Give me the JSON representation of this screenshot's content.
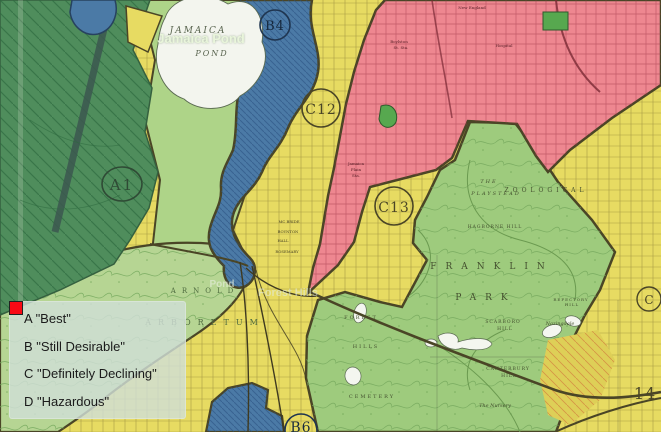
{
  "legend": {
    "items": [
      {
        "grade": "A",
        "label": "A \"Best\"",
        "color": "#0e9c44"
      },
      {
        "grade": "B",
        "label": "B \"Still Desirable\"",
        "color": "#4b2ddc"
      },
      {
        "grade": "C",
        "label": "C \"Definitely Declining\"",
        "color": "#ffd500"
      },
      {
        "grade": "D",
        "label": "D \"Hazardous\"",
        "color": "#f80a14"
      }
    ]
  },
  "map": {
    "zone_labels": {
      "a1": "A1",
      "b4": "B4",
      "c12": "C12",
      "c13": "C13",
      "b6": "B6",
      "c": "C",
      "n14": "14"
    },
    "overlay_labels": {
      "jamaica_pond": "Jamaica Pond",
      "pond": "Pond",
      "forest_hills": "Forest Hills"
    },
    "place_labels": {
      "jamaica": "JAMAICA",
      "pond": "POND",
      "franklin": "FRANKLIN",
      "park": "PARK",
      "arnold": "ARNOLD",
      "arboretum": "ARBORETUM",
      "zoological": "ZOOLOGICAL",
      "the": "THE",
      "playstead": "PLAYSTEAD",
      "hagborne_hill": "HAGBORNE HILL",
      "scarboro": "SCARBORO",
      "scarboro_hill": "HILL",
      "nazingdale": "Nazingdale",
      "refectory": "REFECTORY",
      "refectory_hill": "HILL",
      "canterbury": "CANTERBURY",
      "canterbury_hill": "HILL",
      "nursery": "The Nursery",
      "forest": "FOREST",
      "hills": "HILLS",
      "cemetery": "CEMETERY",
      "boylston": "Boylston",
      "st_sta": "St. Sta.",
      "sta_1": "Jamaica",
      "sta_2": "Plain",
      "sta_3": "Sta.",
      "new_england": "New England",
      "hospital": "Hospital"
    },
    "street_labels": {
      "mc_bride": "MC BRIDE",
      "boynton": "BOYNTON",
      "hall": "HALL",
      "rosemary": "ROSEMARY"
    },
    "colors": {
      "zone_a": "#4f8d5c",
      "zone_b": "#4b7aa6",
      "zone_c": "#e7db62",
      "zone_d": "#ee8790",
      "park": "#9ecb7d",
      "arboretum": "#b6d593",
      "water_white": "#f3f5ee",
      "parklet": "#57a84f",
      "boundary": "#4a4526"
    }
  }
}
